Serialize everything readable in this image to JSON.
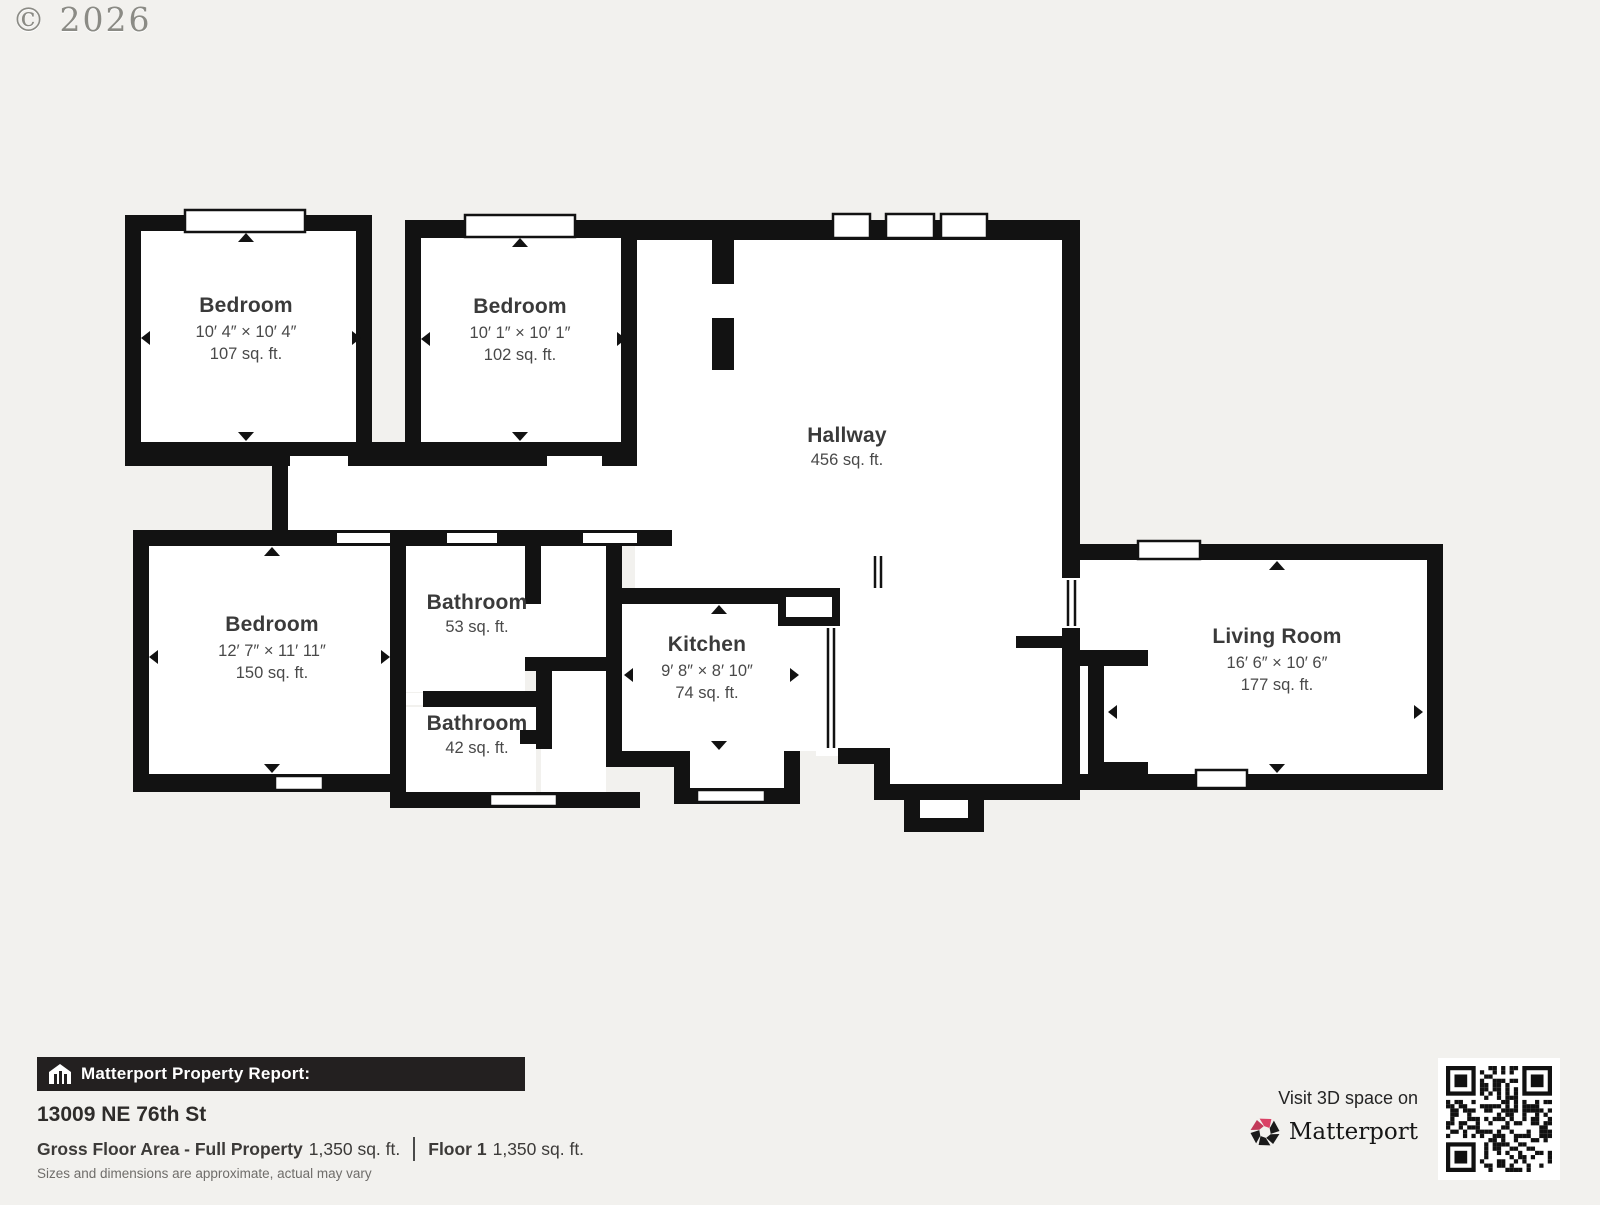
{
  "watermark": "© 2026",
  "colors": {
    "background": "#f2f1ee",
    "wall": "#121212",
    "room_fill": "#ffffff",
    "label_text": "#3a3a3a",
    "footer_bar": "#232020",
    "brand_red": "#da4165"
  },
  "floorplan": {
    "rooms": [
      {
        "id": "bedroom-top-left",
        "name": "Bedroom",
        "dimensions": "10′ 4″ × 10′ 4″",
        "area": "107 sq. ft."
      },
      {
        "id": "bedroom-top-middle",
        "name": "Bedroom",
        "dimensions": "10′ 1″ × 10′ 1″",
        "area": "102 sq. ft."
      },
      {
        "id": "hallway",
        "name": "Hallway",
        "area": "456 sq. ft."
      },
      {
        "id": "bedroom-bottom-left",
        "name": "Bedroom",
        "dimensions": "12′ 7″ × 11′ 11″",
        "area": "150 sq. ft."
      },
      {
        "id": "bathroom-upper",
        "name": "Bathroom",
        "area": "53 sq. ft."
      },
      {
        "id": "bathroom-lower",
        "name": "Bathroom",
        "area": "42 sq. ft."
      },
      {
        "id": "kitchen",
        "name": "Kitchen",
        "dimensions": "9′ 8″ × 8′ 10″",
        "area": "74 sq. ft."
      },
      {
        "id": "living-room",
        "name": "Living Room",
        "dimensions": "16′ 6″ × 10′ 6″",
        "area": "177 sq. ft."
      }
    ]
  },
  "footer": {
    "report_label": "Matterport Property Report:",
    "address": "13009 NE 76th St",
    "gross_label": "Gross Floor Area - Full Property",
    "gross_value": "1,350 sq. ft.",
    "floor_label": "Floor 1",
    "floor_value": "1,350 sq. ft.",
    "disclaimer": "Sizes and dimensions are approximate, actual may vary"
  },
  "cta": {
    "visit_text": "Visit 3D space on",
    "brand": "Matterport"
  }
}
